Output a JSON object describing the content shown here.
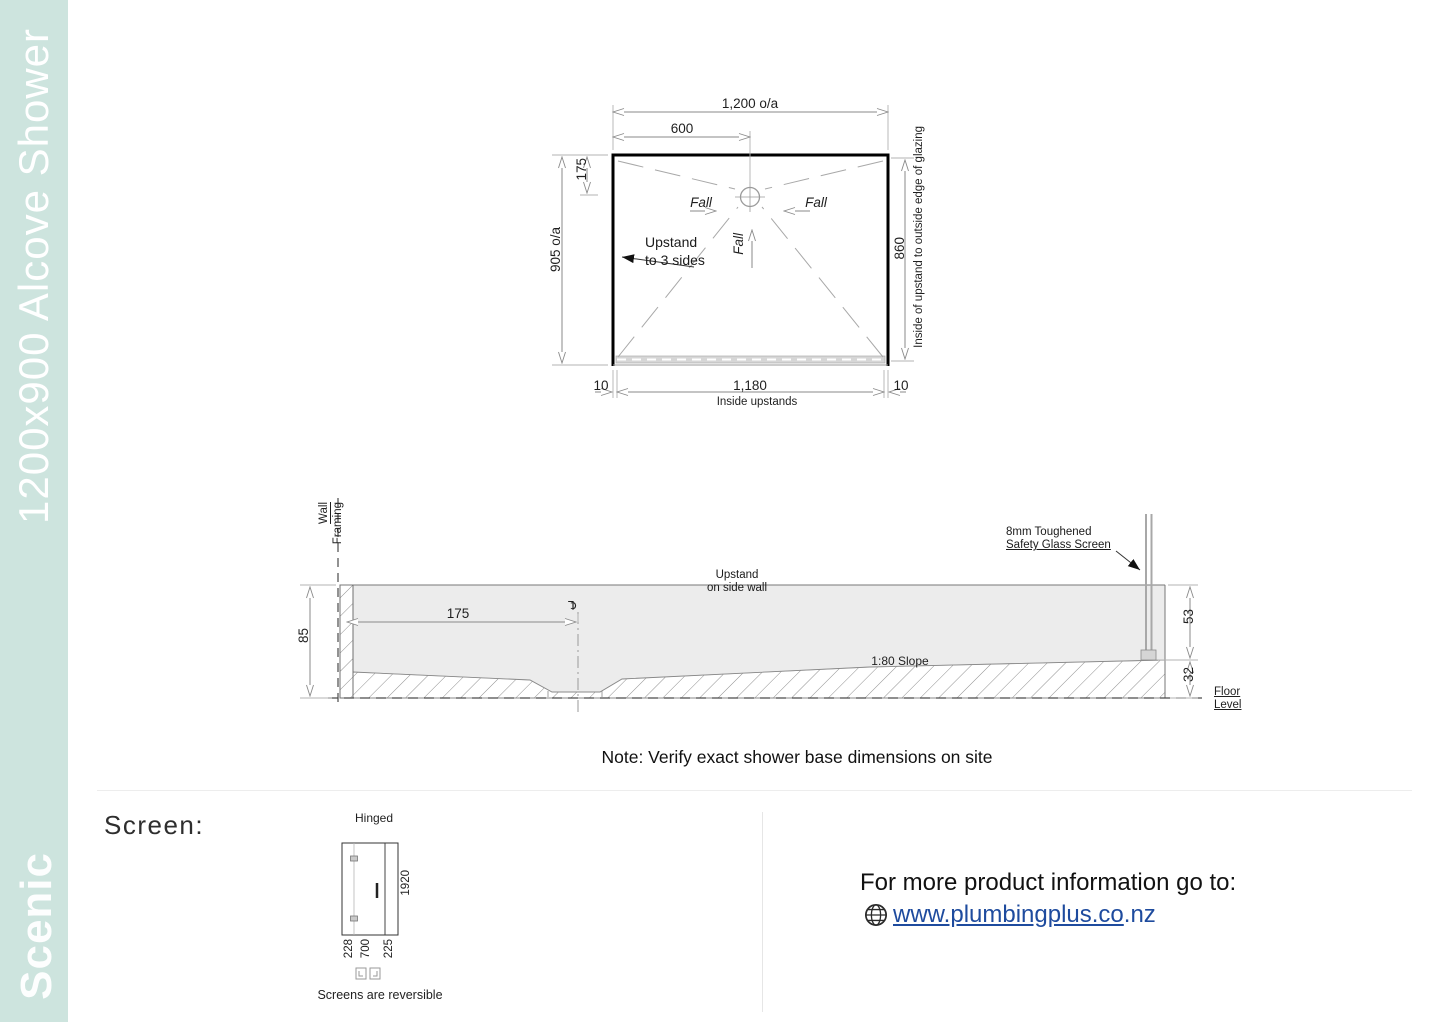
{
  "sidebar": {
    "title": "1200x900 Alcove Shower",
    "brand": "Scenic"
  },
  "plan": {
    "dim_overall_width": "1,200 o/a",
    "dim_drain_x": "600",
    "dim_drain_y": "175",
    "dim_overall_depth": "905 o/a",
    "dim_glazing": "860",
    "glazing_caption": "Inside of upstand to outside edge of glazing",
    "dim_upstand_left": "10",
    "dim_inside": "1,180",
    "dim_upstand_right": "10",
    "inside_caption": "Inside upstands",
    "fall_left": "Fall",
    "fall_right": "Fall",
    "fall_center": "Fall",
    "upstand_note_line1": "Upstand",
    "upstand_note_line2": "to 3 sides"
  },
  "section": {
    "wall_line1": "Wall",
    "wall_line2": "Framing",
    "dim_height": "85",
    "dim_drain_offset": "175",
    "centerline_symbol": "℄",
    "upstand_line1": "Upstand",
    "upstand_line2": "on side wall",
    "glass_line1": "8mm Toughened",
    "glass_line2": "Safety Glass Screen",
    "slope": "1:80 Slope",
    "dim_rim_to_channel": "53",
    "dim_channel_to_floor": "32",
    "floor_label": "Floor Level"
  },
  "note": "Note: Verify exact shower base dimensions on site",
  "screen": {
    "heading": "Screen:",
    "type": "Hinged",
    "dim_height": "1920",
    "dim_left": "228",
    "dim_mid": "700",
    "dim_right": "225",
    "caption": "Screens are reversible"
  },
  "info": {
    "line": "For more product information go to:",
    "url_main": "www.plumbingplus.co",
    "url_tld": ".nz"
  },
  "colors": {
    "sidebar_bg": "#cde4de",
    "link_blue": "#1e4b9e",
    "base_fill": "#ececec"
  }
}
